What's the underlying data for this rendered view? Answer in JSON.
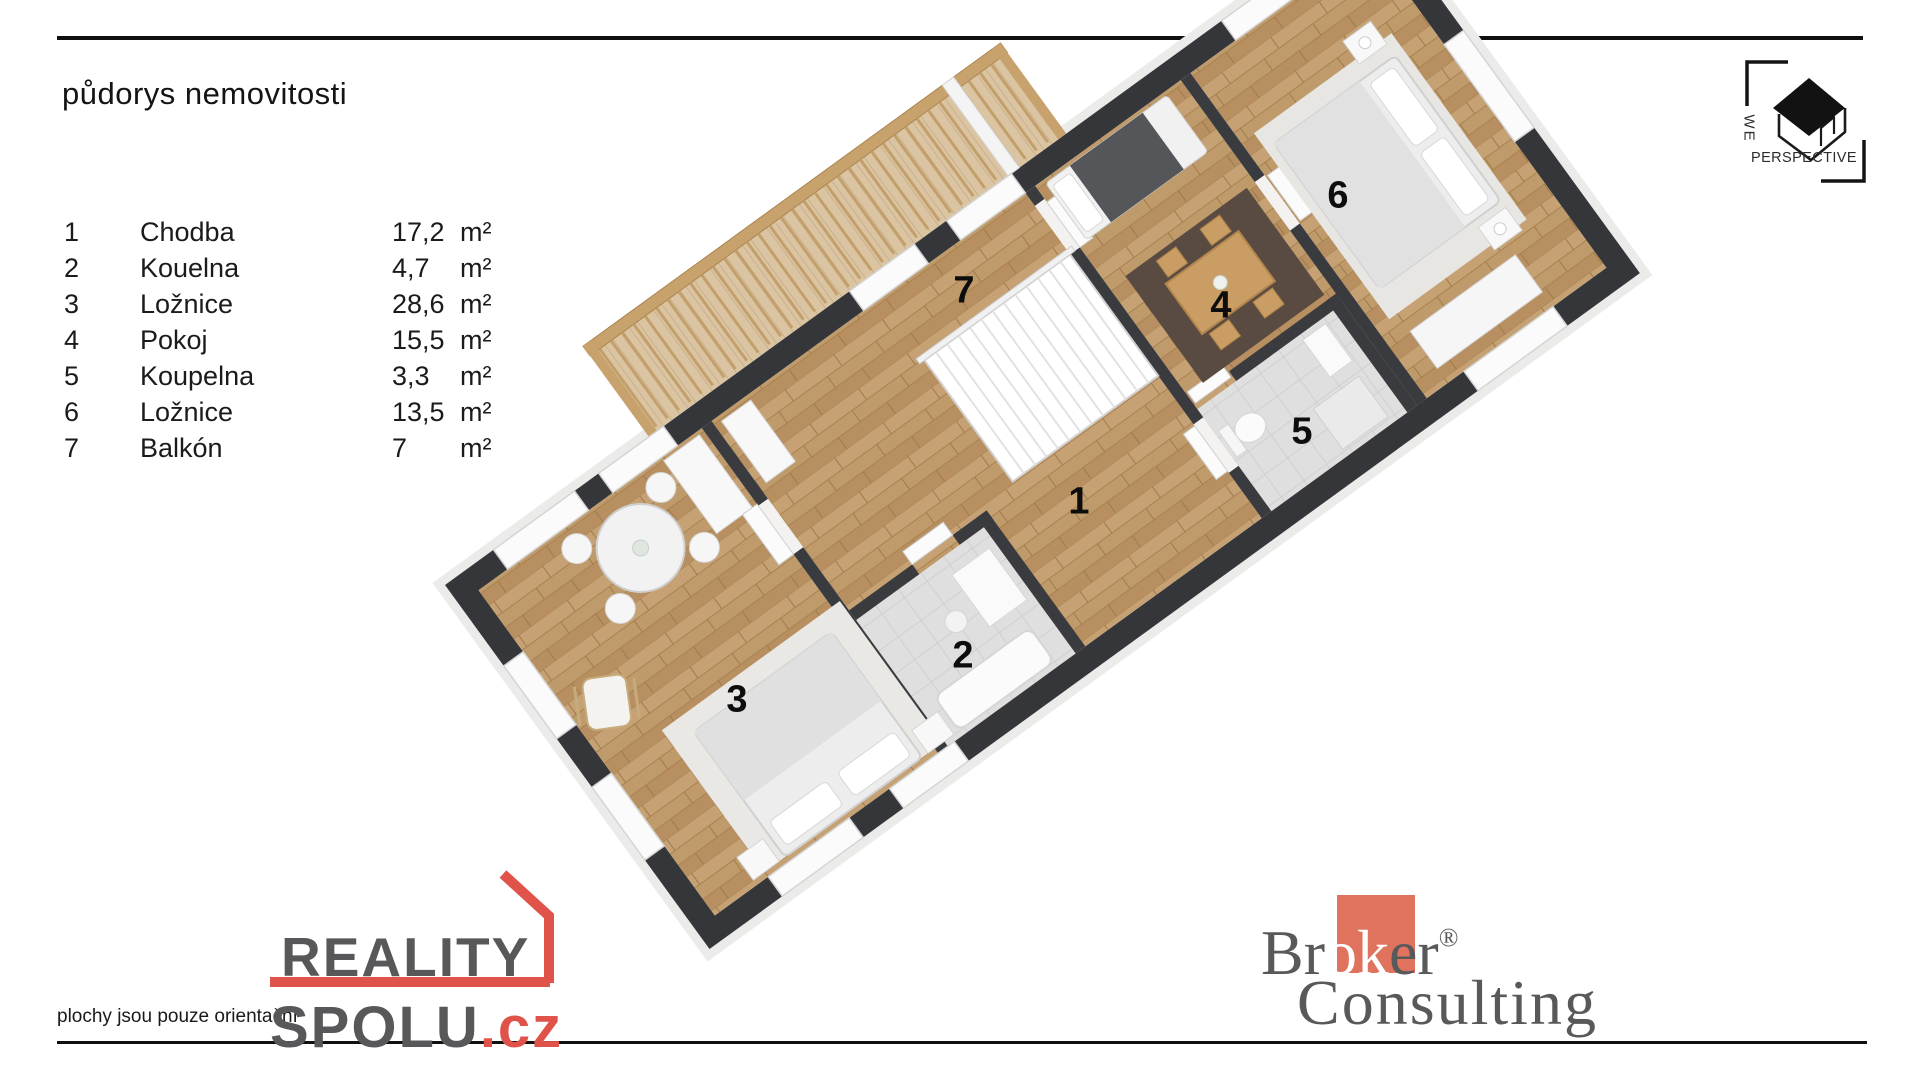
{
  "title": "půdorys nemovitosti",
  "legend": {
    "rooms": [
      {
        "num": "1",
        "name": "Chodba",
        "area": "17,2",
        "unit": "m²"
      },
      {
        "num": "2",
        "name": "Kouelna",
        "area": "4,7",
        "unit": "m²"
      },
      {
        "num": "3",
        "name": "Ložnice",
        "area": "28,6",
        "unit": "m²"
      },
      {
        "num": "4",
        "name": "Pokoj",
        "area": "15,5",
        "unit": "m²"
      },
      {
        "num": "5",
        "name": "Koupelna",
        "area": "3,3",
        "unit": "m²"
      },
      {
        "num": "6",
        "name": "Ložnice",
        "area": "13,5",
        "unit": "m²"
      },
      {
        "num": "7",
        "name": "Balkón",
        "area": "7",
        "unit": "m²"
      }
    ]
  },
  "plan": {
    "labels": [
      "1",
      "2",
      "3",
      "4",
      "5",
      "6",
      "7"
    ]
  },
  "footer": {
    "disclaimer": "plochy jsou pouze orientační"
  },
  "logos": {
    "we_perspective": {
      "line1": "WE",
      "line2": "PERSPECTIVE"
    },
    "reality_spolu": {
      "word1": "REALITY",
      "word2": "SPOLU",
      "tld": ".cz"
    },
    "broker_consulting": {
      "part1": "Br",
      "part2": "ok",
      "part3": "er",
      "reg": "®",
      "line2": "Consulting"
    }
  },
  "colors": {
    "brand_red": "#e0534a",
    "broker_salmon": "#df735e",
    "logo_gray": "#58595b",
    "wall_dark": "#35363a",
    "wood_floor": "#bf9a6a",
    "balcony_wood": "#c8a26d",
    "tile": "#dedede",
    "rug_dark": "#5a4b42"
  }
}
